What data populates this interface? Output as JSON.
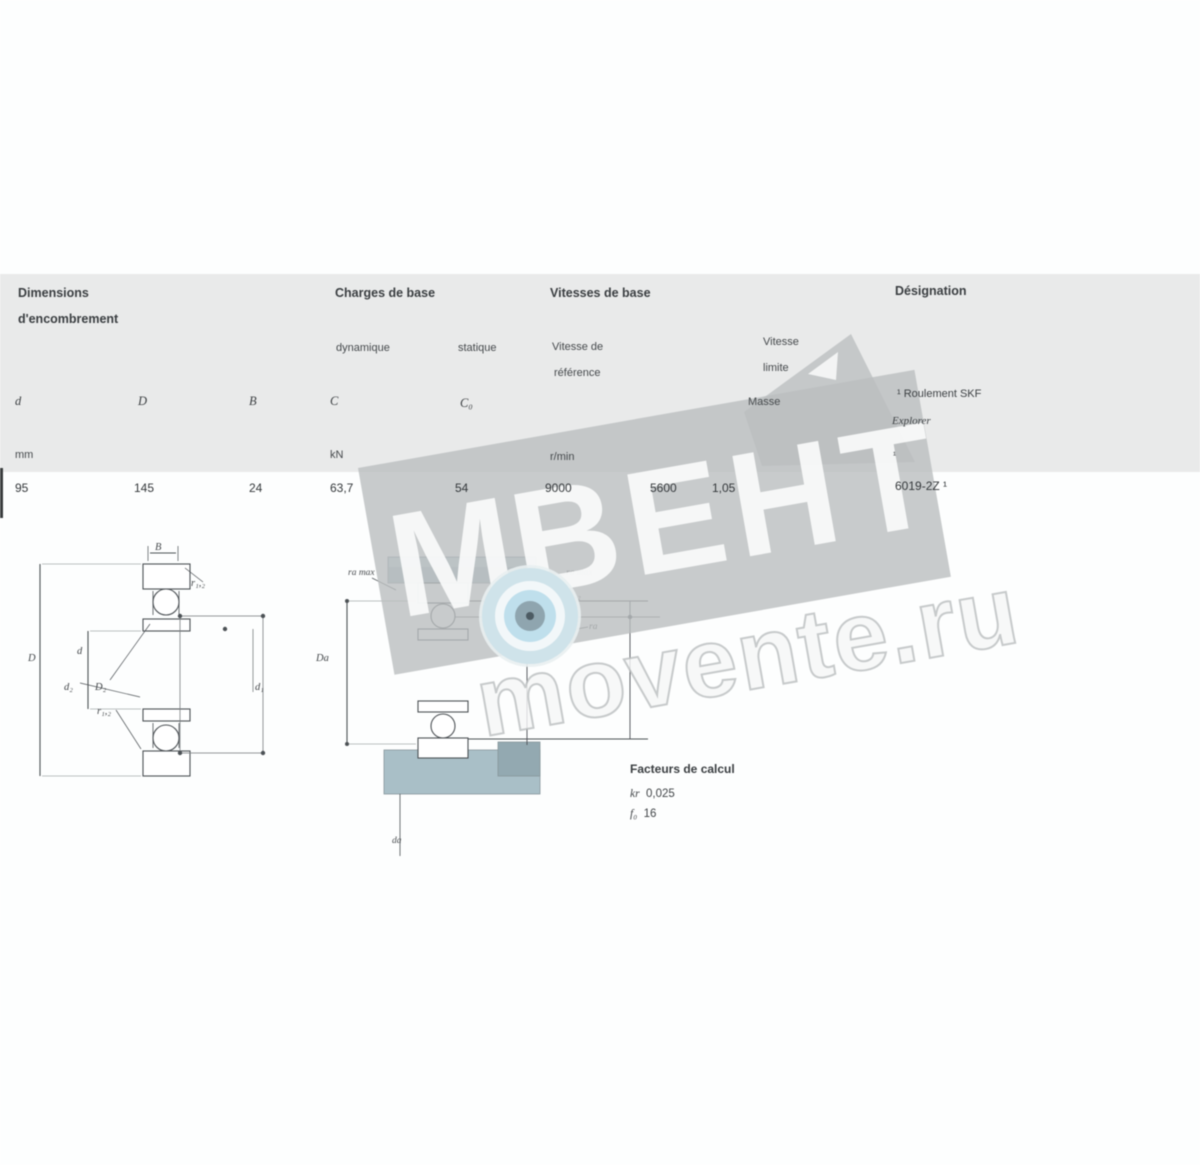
{
  "table": {
    "header": {
      "dim1": "Dimensions",
      "dim2": "d'encombrement",
      "loads": "Charges de base",
      "speeds": "Vitesses de base",
      "designation": "Désignation",
      "dynamic": "dynamique",
      "static": "statique",
      "ref1": "Vitesse de",
      "ref2": "référence",
      "lim1": "Vitesse",
      "lim2": "limite",
      "mass": "Masse"
    },
    "symbols": {
      "d": "d",
      "D": "D",
      "B": "B",
      "C": "C",
      "C0": "C₀"
    },
    "units": {
      "mm": "mm",
      "kN": "kN",
      "rmin": "r/min"
    },
    "row": {
      "d": "95",
      "D": "145",
      "B": "24",
      "C": "63,7",
      "C0": "54",
      "ref": "9000",
      "lim": "5600",
      "mass": "1,05",
      "designation": "6019-2Z ¹"
    },
    "note1": "¹ Roulement SKF",
    "note2": "Explorer",
    "note_mark": "¹"
  },
  "figures": {
    "left": {
      "B": "B",
      "r12top": "r₁,₂",
      "D": "D",
      "d": "d",
      "d2": "d₂",
      "D2": "D₂",
      "r12mid": "r₁,₂",
      "d1": "d₁"
    },
    "middle": {
      "ra_top": "ra max",
      "Da": "Da",
      "da": "da",
      "lbl1": "ra max",
      "lbl2": "r₁,₂",
      "lbl3": "ra"
    }
  },
  "calc": {
    "heading": "Facteurs de calcul",
    "kr": "kr",
    "kr_value": "0,025",
    "f0": "f₀",
    "f0_value": "16"
  },
  "watermark": {
    "m": "М",
    "brand": "ВЕНТ",
    "site": "movente.ru"
  },
  "colors": {
    "panel": "#e9eaea",
    "band": "#bbbfc0",
    "teal": "#a9bfc7",
    "teal_light": "#c3d4d9",
    "logo_blue": "#bfdfec",
    "line": "#4d5256"
  }
}
